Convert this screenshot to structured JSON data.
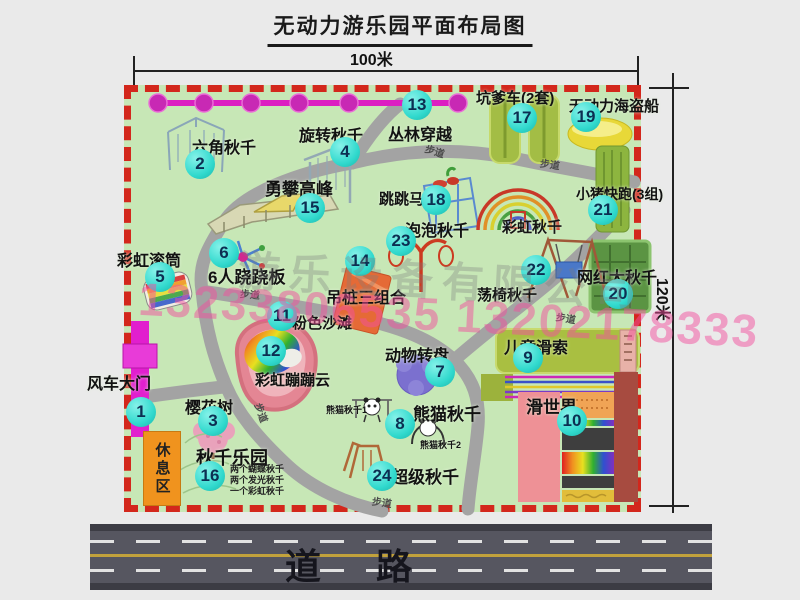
{
  "title": "无动力游乐园平面布局图",
  "dimensions": {
    "top": "100米",
    "right": "120米"
  },
  "road": {
    "label": "道路"
  },
  "watermark": {
    "company": "游乐设备有限公司",
    "phone": "13233806535 13202178333"
  },
  "rest_area": {
    "label": "休息区"
  },
  "map": {
    "walkway_label_text": "步道",
    "walkway_labels": [
      {
        "x": 425,
        "y": 143,
        "rot": 18
      },
      {
        "x": 540,
        "y": 156,
        "rot": 8
      },
      {
        "x": 240,
        "y": 286,
        "rot": 5
      },
      {
        "x": 556,
        "y": 310,
        "rot": 10
      },
      {
        "x": 252,
        "y": 405,
        "rot": 70
      },
      {
        "x": 372,
        "y": 494,
        "rot": 8
      }
    ],
    "attractions": [
      {
        "num": "1",
        "label": "风车大门",
        "size": 16,
        "label_x": 87,
        "label_y": 370,
        "badge_x": 141,
        "badge_y": 412
      },
      {
        "num": "2",
        "label": "六角秋千",
        "size": 16,
        "label_x": 192,
        "label_y": 134,
        "badge_x": 200,
        "badge_y": 164
      },
      {
        "num": "3",
        "label": "樱花树",
        "size": 16,
        "label_x": 185,
        "label_y": 394,
        "badge_x": 213,
        "badge_y": 421
      },
      {
        "num": "4",
        "label": "旋转秋千",
        "size": 16,
        "label_x": 299,
        "label_y": 122,
        "badge_x": 345,
        "badge_y": 152
      },
      {
        "num": "5",
        "label": "彩虹滚筒",
        "size": 16,
        "label_x": 117,
        "label_y": 247,
        "badge_x": 160,
        "badge_y": 277
      },
      {
        "num": "6",
        "label": "6人跷跷板",
        "size": 17,
        "label_x": 208,
        "label_y": 263,
        "badge_x": 224,
        "badge_y": 253
      },
      {
        "num": "7",
        "label": "动物转盘",
        "size": 16,
        "label_x": 385,
        "label_y": 342,
        "badge_x": 440,
        "badge_y": 372
      },
      {
        "num": "8",
        "label": "熊猫秋千",
        "size": 17,
        "label_x": 413,
        "label_y": 400,
        "badge_x": 400,
        "badge_y": 424
      },
      {
        "num": "9",
        "label": "儿童滑索",
        "size": 16,
        "label_x": 504,
        "label_y": 334,
        "badge_x": 528,
        "badge_y": 358
      },
      {
        "num": "10",
        "label": "滑世界",
        "size": 17,
        "label_x": 526,
        "label_y": 393,
        "badge_x": 572,
        "badge_y": 421
      },
      {
        "num": "11",
        "label": "粉色沙滩",
        "size": 15,
        "label_x": 292,
        "label_y": 312,
        "badge_x": 282,
        "badge_y": 316
      },
      {
        "num": "12",
        "label": "彩虹蹦蹦云",
        "size": 15,
        "label_x": 255,
        "label_y": 369,
        "badge_x": 271,
        "badge_y": 351
      },
      {
        "num": "13",
        "label": "丛林穿越",
        "size": 16,
        "label_x": 388,
        "label_y": 121,
        "badge_x": 417,
        "badge_y": 105
      },
      {
        "num": "14",
        "label": "吊桩三组合",
        "size": 16,
        "label_x": 326,
        "label_y": 284,
        "badge_x": 360,
        "badge_y": 261
      },
      {
        "num": "15",
        "label": "勇攀高峰",
        "size": 17,
        "label_x": 265,
        "label_y": 175,
        "badge_x": 310,
        "badge_y": 208
      },
      {
        "num": "16",
        "label": "秋千乐园",
        "size": 18,
        "label_x": 196,
        "label_y": 444,
        "badge_x": 210,
        "badge_y": 476,
        "notes": [
          "两个蝴蝶秋千",
          "两个发光秋千",
          "一个彩虹秋千"
        ],
        "notes_x": 230,
        "notes_y": 464
      },
      {
        "num": "17",
        "label": "坑爹车(2套)",
        "size": 15,
        "label_x": 476,
        "label_y": 87,
        "badge_x": 522,
        "badge_y": 118
      },
      {
        "num": "18",
        "label": "跳跳马",
        "size": 15,
        "label_x": 379,
        "label_y": 188,
        "badge_x": 436,
        "badge_y": 200
      },
      {
        "num": "19",
        "label": "无动力海盗船",
        "size": 15,
        "label_x": 569,
        "label_y": 95,
        "badge_x": 586,
        "badge_y": 117
      },
      {
        "num": "20",
        "label": "网红大秋千",
        "size": 16,
        "label_x": 577,
        "label_y": 264,
        "badge_x": 618,
        "badge_y": 294
      },
      {
        "num": "21",
        "label": "小猪快跑(3组)",
        "size": 14,
        "label_x": 576,
        "label_y": 184,
        "badge_x": 603,
        "badge_y": 210
      },
      {
        "num": "22",
        "label": "荡椅秋千",
        "size": 15,
        "label_x": 477,
        "label_y": 284,
        "badge_x": 536,
        "badge_y": 270
      },
      {
        "num": "23",
        "label": "泡泡秋千",
        "size": 16,
        "label_x": 405,
        "label_y": 217,
        "badge_x": 401,
        "badge_y": 241
      },
      {
        "num": "24",
        "label": "超级秋千",
        "size": 17,
        "label_x": 391,
        "label_y": 463,
        "badge_x": 382,
        "badge_y": 476
      }
    ],
    "extra_labels": [
      {
        "text": "彩虹秋千",
        "x": 502,
        "y": 216,
        "size": 15
      },
      {
        "text": "熊猫秋千1",
        "x": 326,
        "y": 403,
        "size": 9
      },
      {
        "text": "熊猫秋千2",
        "x": 420,
        "y": 438,
        "size": 9
      }
    ]
  }
}
